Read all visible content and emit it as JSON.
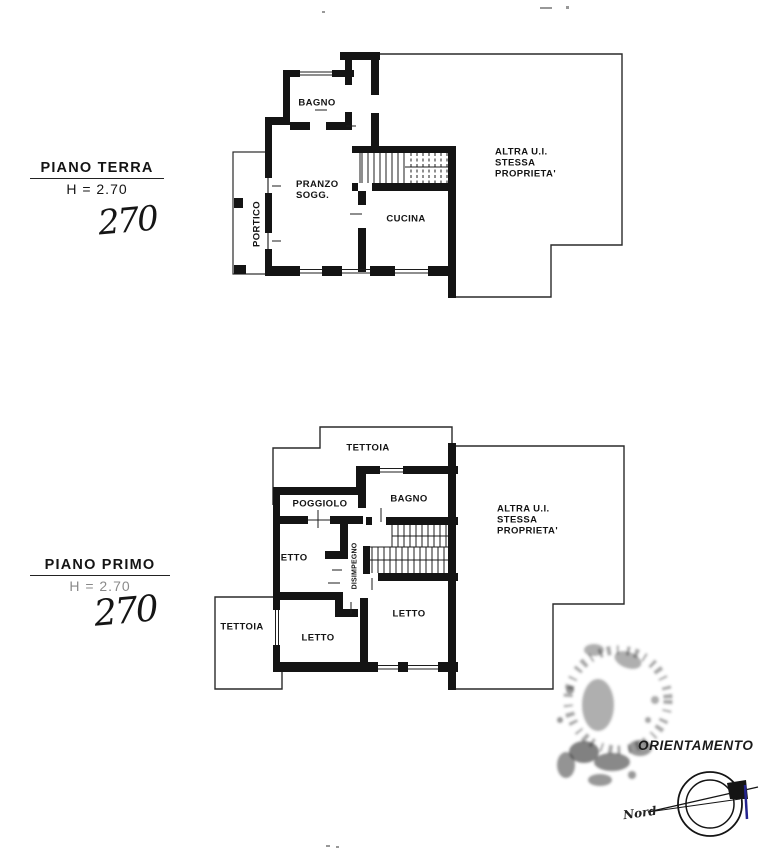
{
  "document": {
    "type_label": "planimetria catastale",
    "ink_color": "#141414",
    "compass_tick_color": "#23238e"
  },
  "floors": [
    {
      "title": "PIANO TERRA",
      "height_label": "H = 2.70",
      "handwritten_height": "270",
      "rooms": {
        "bagno": "BAGNO",
        "pranzo_soggiorno": "PRANZO\nSOGG.",
        "cucina": "CUCINA",
        "portico": "PORTICO",
        "altra_ui": "ALTRA U.I.\nSTESSA\nPROPRIETA'"
      }
    },
    {
      "title": "PIANO PRIMO",
      "height_label": "H = 2.70",
      "handwritten_height": "270",
      "rooms": {
        "tettoia_top": "TETTOIA",
        "poggiolo": "POGGIOLO",
        "bagno": "BAGNO",
        "letto_mid": "LETTO",
        "disimpegno": "DISIMPEGNO",
        "letto_bottom_right": "LETTO",
        "letto_bottom_left": "LETTO",
        "tettoia_left": "TETTOIA",
        "altra_ui": "ALTRA U.I.\nSTESSA\nPROPRIETA'"
      }
    }
  ],
  "orientation": {
    "label": "ORIENTAMENTO",
    "north_label": "Nord"
  }
}
